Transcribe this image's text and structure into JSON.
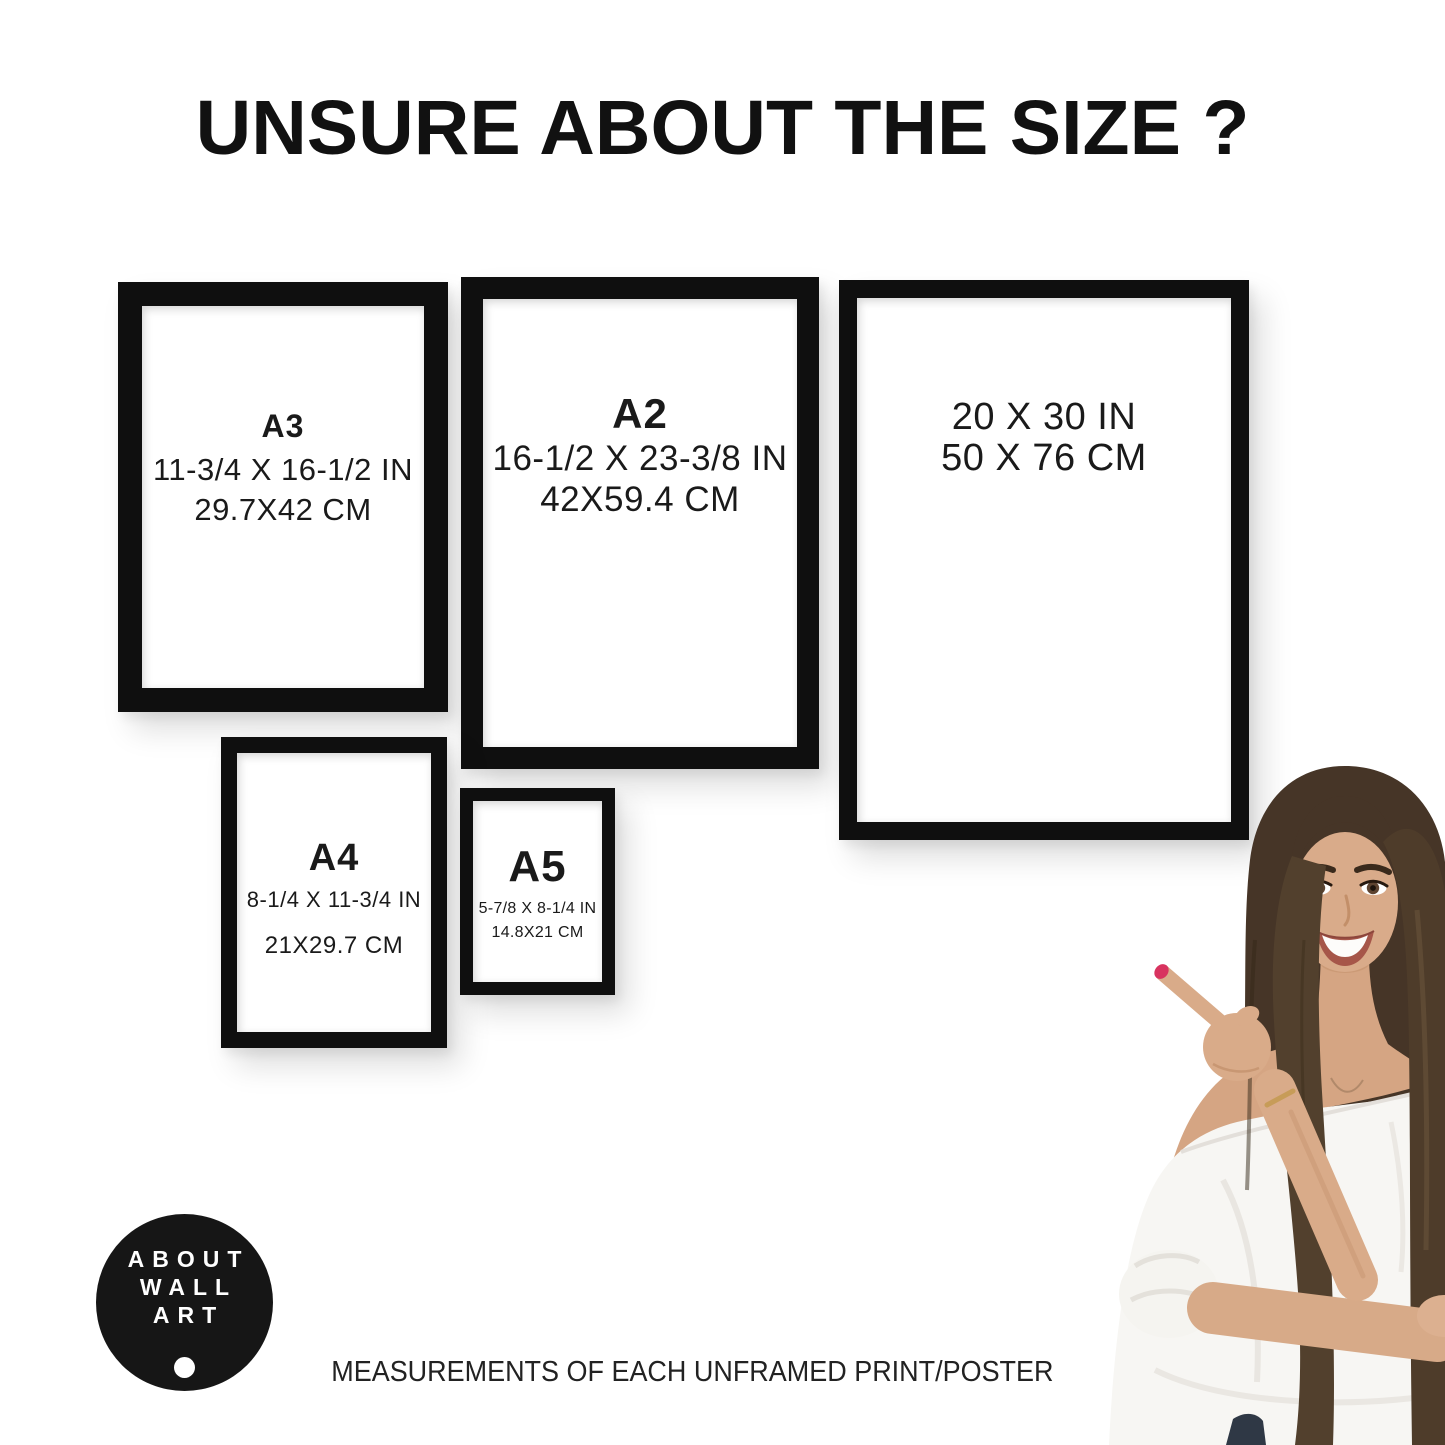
{
  "title": "UNSURE ABOUT THE SIZE ?",
  "caption": "MEASUREMENTS OF EACH UNFRAMED PRINT/POSTER",
  "logo": {
    "line1": "ABOUT",
    "line2": "WALL",
    "line3": "ART"
  },
  "frames": {
    "a3": {
      "label": "A3",
      "inches": "11-3/4 X 16-1/2 IN",
      "cm": "29.7X42 CM"
    },
    "a2": {
      "label": "A2",
      "inches": "16-1/2 X 23-3/8 IN",
      "cm": "42X59.4 CM"
    },
    "p2030": {
      "inches": "20 X 30 IN",
      "cm": "50 X 76 CM"
    },
    "a4": {
      "label": "A4",
      "inches": "8-1/4 X 11-3/4 IN",
      "cm": "21X29.7 CM"
    },
    "a5": {
      "label": "A5",
      "inches": "5-7/8 X 8-1/4 IN",
      "cm": "14.8X21 CM"
    }
  },
  "colors": {
    "background": "#ffffff",
    "frame": "#0f0f0f",
    "text": "#1a1a1a",
    "logo_background": "#161616",
    "logo_text": "#ffffff",
    "skin": "#d9ab89",
    "hair": "#463527",
    "blouse": "#f7f6f3",
    "nail": "#d8335f",
    "jeans": "#2f3845",
    "bracelet": "#c79c58"
  }
}
